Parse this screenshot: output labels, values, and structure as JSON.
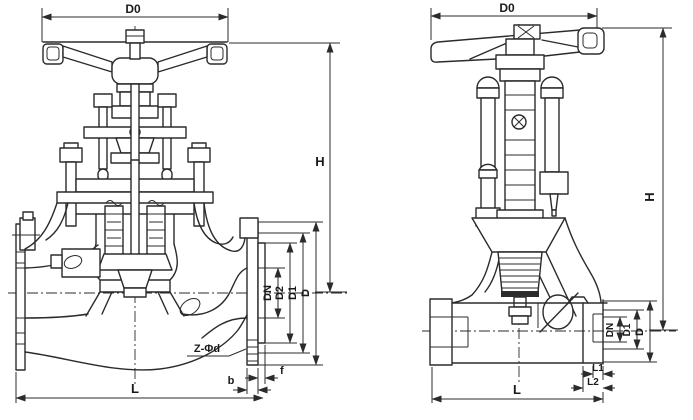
{
  "drawing": {
    "colors": {
      "line": "#2b2b2b",
      "background": "#ffffff"
    },
    "left_valve": {
      "labels": {
        "d0": "D0",
        "h": "H",
        "dn": "DN",
        "d2": "D2",
        "d1": "D1",
        "d": "D",
        "bolt_holes": "Z-Φd",
        "b": "b",
        "f": "f",
        "l": "L"
      }
    },
    "right_valve": {
      "labels": {
        "d0": "D0",
        "h": "H",
        "dn": "DN",
        "d1": "D1",
        "d": "D",
        "l1": "L1",
        "l2": "L2",
        "l": "L"
      }
    }
  }
}
